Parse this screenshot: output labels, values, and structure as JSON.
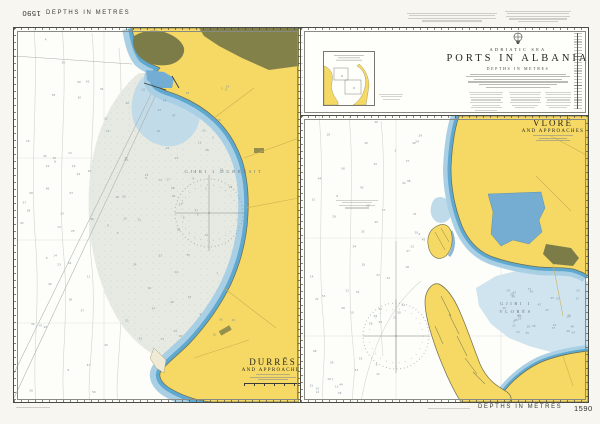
{
  "sheet": {
    "chart_number": "1590",
    "margin_top_depths": "DEPTHS IN METRES",
    "margin_bottom_depths": "DEPTHS IN METRES"
  },
  "title_block": {
    "sea_name": "ADRIATIC SEA",
    "title": "PORTS IN ALBANIA",
    "depths_note": "DEPTHS IN METRES"
  },
  "durres_panel": {
    "title": "DURRËS",
    "subtitle": "AND APPROACHES",
    "bay_label": "GJIRI I DURRËSIT"
  },
  "vlore_panel": {
    "title": "VLORË",
    "subtitle": "AND APPROACHES",
    "bay_label_line1": "GJIRI I",
    "bay_label_line2": "VLORËS"
  },
  "colors": {
    "land_yellow": "#f6d964",
    "urban_olive": "#7c7c49",
    "shallow_blue": "#5fa8d0",
    "light_blue": "#a9cfe4",
    "bay_tint": "#e6eae2",
    "ink": "#4a4a46"
  }
}
